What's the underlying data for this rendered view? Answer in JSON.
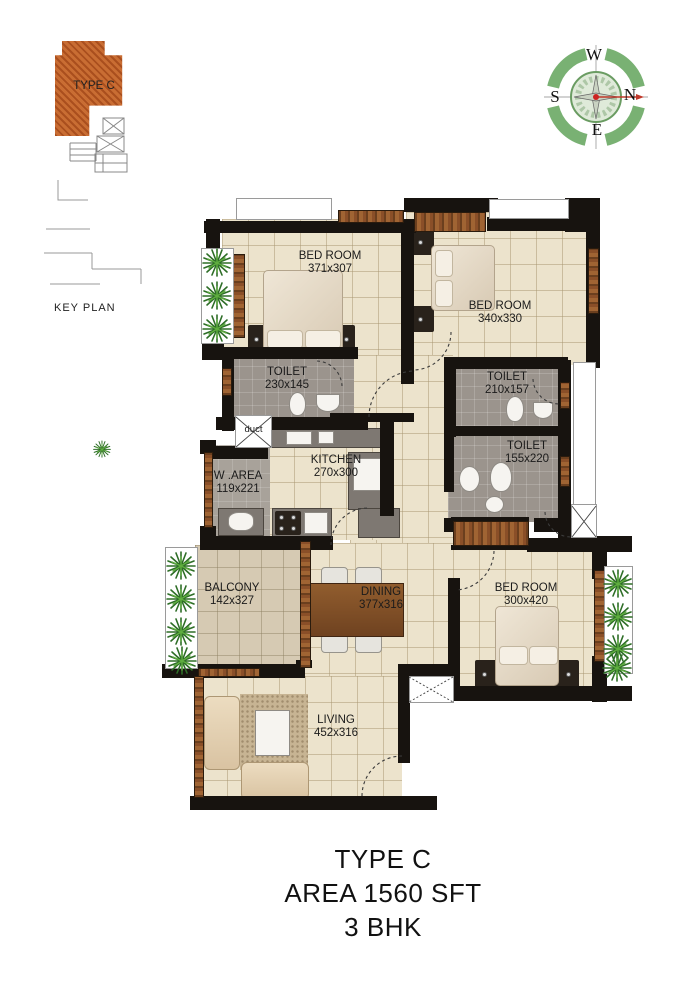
{
  "key_plan": {
    "unit_label": "TYPE C",
    "caption": "KEY PLAN"
  },
  "compass": {
    "top": "W",
    "right": "N",
    "bottom": "E",
    "left": "S"
  },
  "plan": {
    "bedroom1": {
      "name": "BED ROOM",
      "dims": "371x307"
    },
    "bedroom2": {
      "name": "BED ROOM",
      "dims": "340x330"
    },
    "bedroom3": {
      "name": "BED ROOM",
      "dims": "300x420"
    },
    "toilet1": {
      "name": "TOILET",
      "dims": "230x145"
    },
    "toilet2": {
      "name": "TOILET",
      "dims": "210x157"
    },
    "toilet3": {
      "name": "TOILET",
      "dims": "155x220"
    },
    "kitchen": {
      "name": "KITCHEN",
      "dims": "270x300"
    },
    "work_area": {
      "name": "W .AREA",
      "dims": "119x221"
    },
    "balcony": {
      "name": "BALCONY",
      "dims": "142x327"
    },
    "dining": {
      "name": "DINING",
      "dims": "377x316"
    },
    "living": {
      "name": "LIVING",
      "dims": "452x316"
    },
    "duct": {
      "name": "duct"
    }
  },
  "footer": {
    "title": "TYPE C",
    "area": "AREA  1560 SFT",
    "config": "3 BHK"
  },
  "colors": {
    "wall": "#17130f",
    "floor_tile": "#ece3cc",
    "toilet_floor": "#9b948d",
    "wood": "#96582c",
    "key_plan_fill": "#c96d33",
    "plant": "#3f7d2f",
    "compass_green": "#79b173"
  }
}
